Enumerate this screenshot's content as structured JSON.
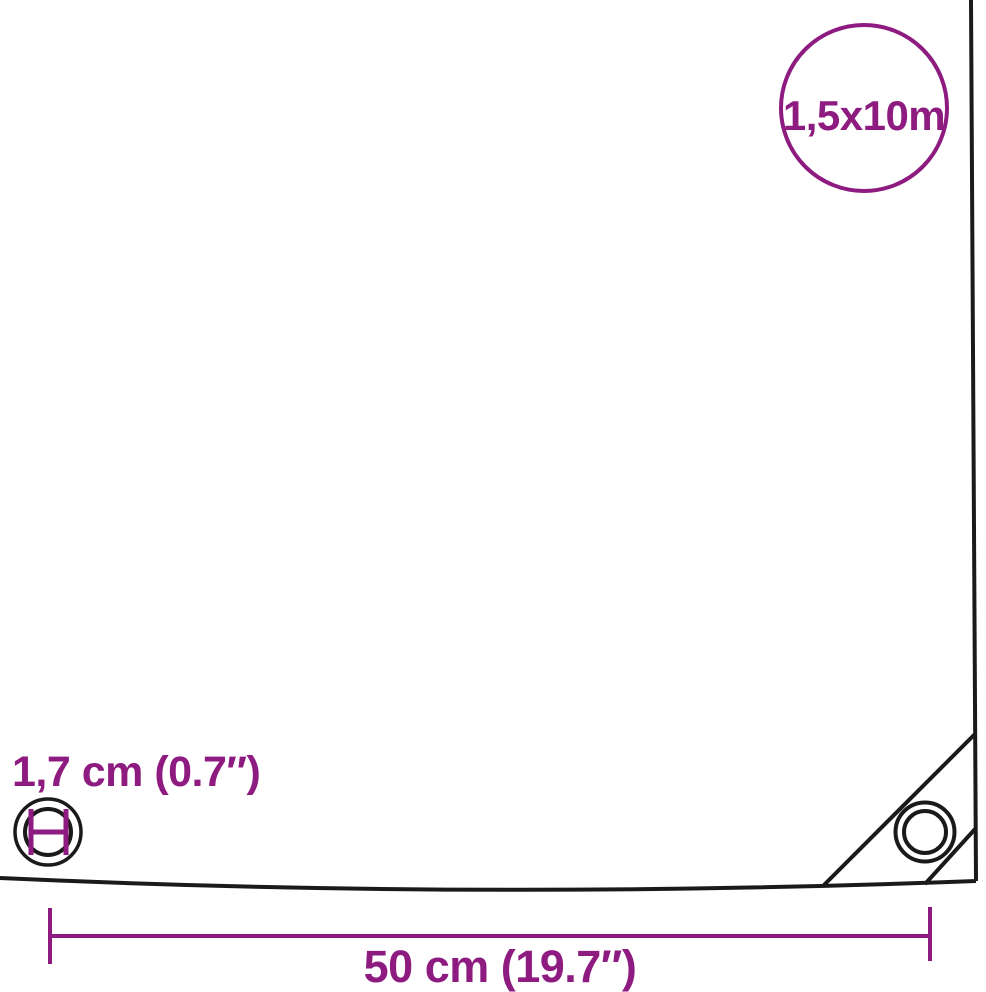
{
  "colors": {
    "accent": "#8E1B80",
    "outline": "#1A1A1A",
    "background": "#FFFFFF"
  },
  "size_badge": {
    "label": "1,5x10m",
    "icon": "circle-outline-badge"
  },
  "grommet_detail": {
    "label": "1,7 cm (0.7″)",
    "icon": "grommet-eyelet-diameter-icon"
  },
  "corner_patch": {
    "icon": "grommet-eyelet-icon"
  },
  "width_dimension": {
    "label": "50 cm (19.7″)",
    "icon": "dimension-line-end-ticks"
  }
}
